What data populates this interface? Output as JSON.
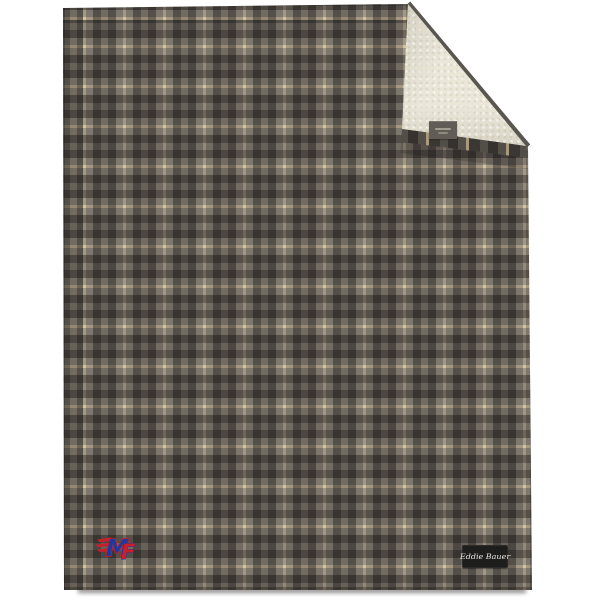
{
  "scene": {
    "description": "Product photo of a gray plaid fleece blanket with its top-right corner folded down to show a cream sherpa lining",
    "background_color": "#ffffff"
  },
  "blanket": {
    "brand_tag": {
      "label": "Eddie Bauer"
    },
    "logo": {
      "letter_m": "M",
      "letter_f": "F"
    }
  },
  "theme": {
    "background": "#ffffff",
    "plaid_cream": "#eadfc7",
    "plaid_light": "#b3aea7",
    "plaid_medium": "#a29d96",
    "plaid_dark": "#787470",
    "sherpa": "#ebe7d8",
    "edge_binding": "#59554f",
    "tag_dark": "#615c55",
    "tag_black": "#1d1d1c",
    "tag_text": "#e9e7e2",
    "logo_red": "#c8202b",
    "logo_blue": "#1e3a9f",
    "shadow": "rgba(35,30,25,0.5)"
  }
}
